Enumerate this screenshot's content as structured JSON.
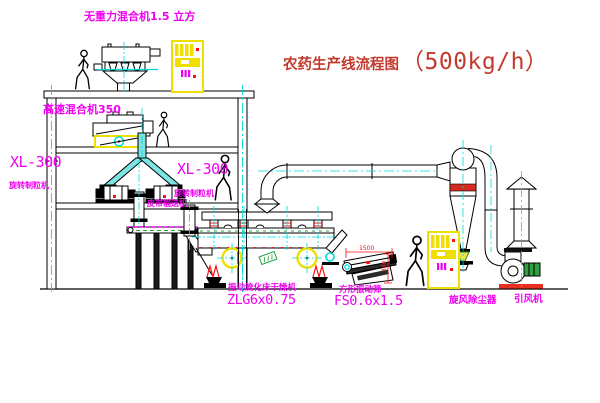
{
  "title": {
    "text": "农药生产线流程图",
    "capacity": "（500kg/h）"
  },
  "equipment_labels": {
    "gravity_mixer": "无重力混合机1.5 立方",
    "high_speed_mixer": "高速混合机350",
    "granulator_left": {
      "model": "XL-300",
      "name": "旋转制粒机"
    },
    "granulator_center": {
      "model": "XL-300",
      "name": "旋转制粒机"
    },
    "belt_conveyor": "皮带输送机",
    "fluid_bed_dryer": {
      "name": "振动流化床干燥机",
      "model": "ZLG6x0.75"
    },
    "vibrating_screen": {
      "name": "方形振动筛",
      "model": "FS0.6x1.5"
    },
    "cyclone": "旋风除尘器",
    "induced_draft_fan": "引风机"
  },
  "dimensions": {
    "screen_width": "1500",
    "screen_height": "340"
  },
  "colors": {
    "label_magenta": "#f000f0",
    "title_red": "#c23b2e",
    "centerline_cyan": "#00dcdc",
    "cabinet_yellow": "#efdf00",
    "accent_green": "#1fa33c",
    "dimension_red": "#ff1010"
  }
}
